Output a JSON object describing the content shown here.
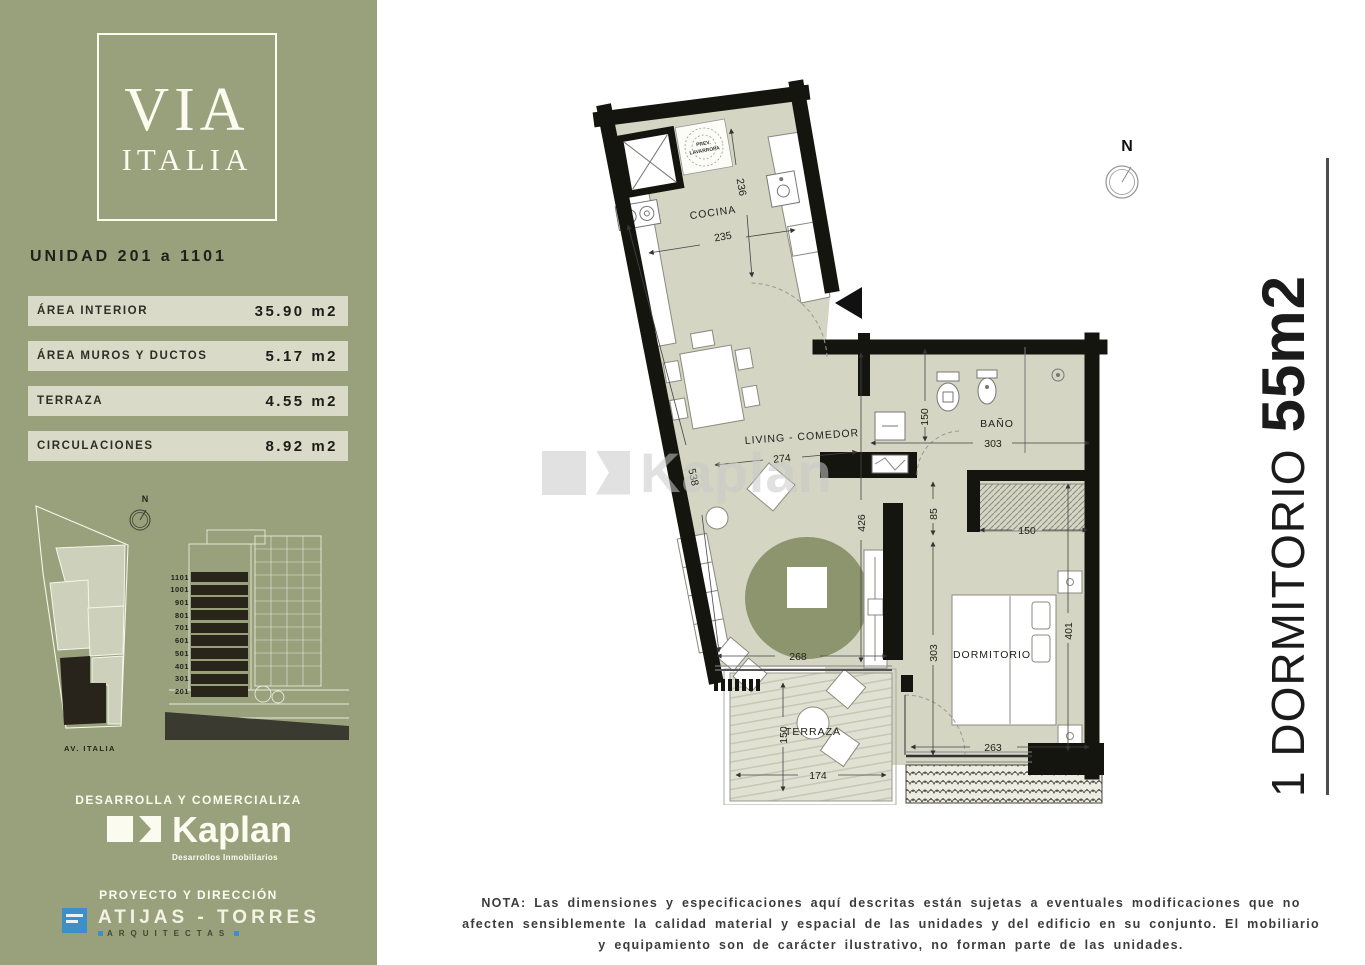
{
  "sidebar": {
    "logo": {
      "line1": "VIA",
      "line2": "ITALIA"
    },
    "unit_title": "UNIDAD 201 a 1101",
    "areas": [
      {
        "label": "ÁREA INTERIOR",
        "value": "35.90 m2"
      },
      {
        "label": "ÁREA MUROS Y DUCTOS",
        "value": "5.17 m2"
      },
      {
        "label": "TERRAZA",
        "value": "4.55 m2"
      },
      {
        "label": "CIRCULACIONES",
        "value": "8.92 m2"
      }
    ],
    "site_plan": {
      "north_label": "N",
      "street_label": "AV. ITALIA"
    },
    "elevation": {
      "floors": [
        "1101",
        "1001",
        "901",
        "801",
        "701",
        "601",
        "501",
        "401",
        "301",
        "201"
      ]
    },
    "developer": {
      "heading": "DESARROLLA Y COMERCIALIZA",
      "name": "Kaplan",
      "tagline": "Desarrollos Inmobiliarios"
    },
    "architects": {
      "heading": "PROYECTO Y DIRECCIÓN",
      "name": "ATIJAS - TORRES",
      "subtitle": "ARQUITECTAS"
    }
  },
  "plan": {
    "north_label": "N",
    "watermark": "Kaplan",
    "rooms": {
      "kitchen": "COCINA",
      "laundry_l1": "PREV.",
      "laundry_l2": "LAVARROPA",
      "living": "LIVING - COMEDOR",
      "bath": "BAÑO",
      "bedroom": "DORMITORIO",
      "terrace": "TERRAZA"
    },
    "dims": {
      "kitchen_d": "236",
      "kitchen_w": "235",
      "living_w": "274",
      "side_wall": "538",
      "living_h": "426",
      "bath_h": "150",
      "bath_w": "303",
      "hall_gap": "85",
      "closet_w": "150",
      "corridor_h": "303",
      "bed_h": "401",
      "bed_w": "263",
      "living_bottom": "268",
      "terrace_h": "150",
      "terrace_w": "174"
    }
  },
  "title": {
    "prefix": "1 DORMITORIO",
    "size": "55m2"
  },
  "note": "NOTA: Las dimensiones y especificaciones aquí descritas están sujetas a eventuales modificaciones que no afecten sensiblemente la calidad material y espacial de las unidades y del edificio en su conjunto. El mobiliario y equipamiento son de carácter ilustrativo, no forman parte de las unidades.",
  "colors": {
    "sidebar": "#98a17c",
    "row_bg": "#d9dbc8",
    "floor": "#d4d5c3",
    "rug": "#8d956e",
    "wall": "#15150f",
    "accent_blue": "#3d8ec9"
  }
}
